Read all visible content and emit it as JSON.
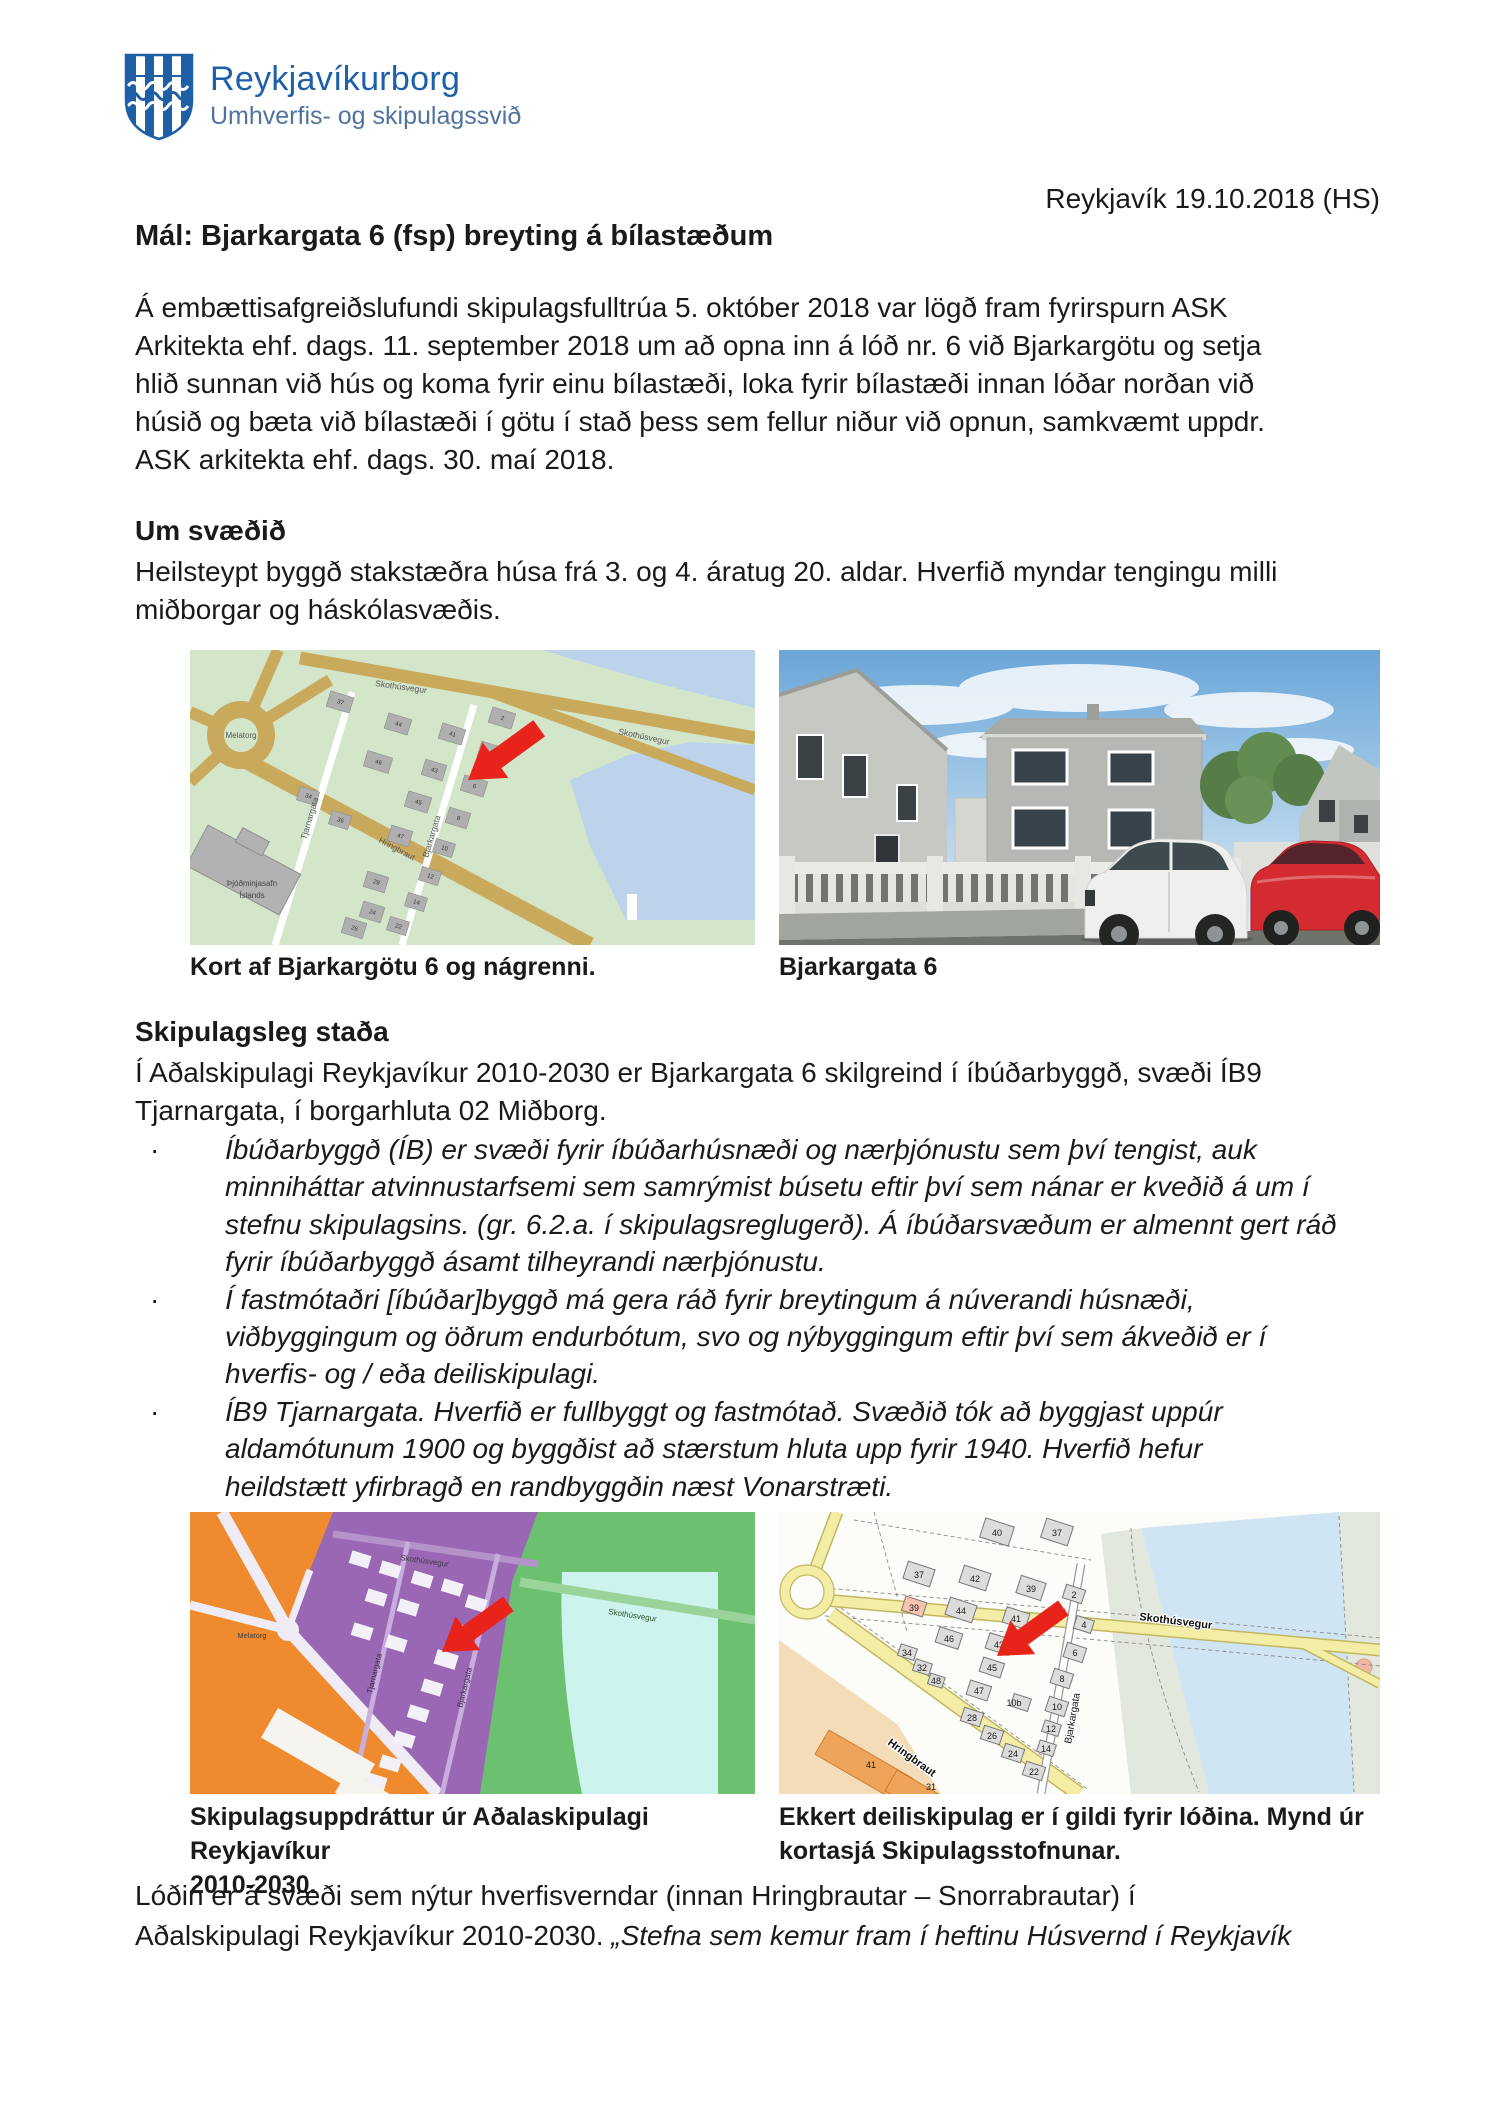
{
  "header": {
    "org_name": "Reykjavíkurborg",
    "org_dept": "Umhverfis- og skipulagssvið",
    "date_line": "Reykjavík 19.10.2018 (HS)",
    "title": "Mál: Bjarkargata 6 (fsp) breyting á bílastæðum"
  },
  "intro": {
    "lines": [
      "Á embættisafgreiðslufundi skipulagsfulltrúa 5. október 2018 var lögð fram fyrirspurn ASK",
      "Arkitekta ehf. dags. 11. september 2018 um að opna inn á lóð nr. 6 við Bjarkargötu og setja",
      "hlið sunnan við hús og koma fyrir einu bílastæði, loka fyrir bílastæði innan lóðar norðan við",
      "húsið og bæta við bílastæði í götu í stað þess sem fellur niður við opnun, samkvæmt uppdr.",
      "ASK arkitekta ehf. dags. 30. maí 2018."
    ]
  },
  "um_svaedid": {
    "heading": "Um svæðið",
    "lines": [
      "Heilsteypt byggð stakstæðra húsa frá 3. og 4. áratug 20. aldar. Hverfið myndar tengingu milli",
      "miðborgar og háskólasvæðis."
    ]
  },
  "figures_row1": {
    "left_caption": "Kort af Bjarkargötu 6 og nágrenni.",
    "right_caption": "Bjarkargata 6"
  },
  "skipulagsleg": {
    "heading": "Skipulagsleg staða",
    "lines": [
      "Í Aðalskipulagi Reykjavíkur 2010-2030 er Bjarkargata 6 skilgreind í íbúðarbyggð, svæði ÍB9",
      "Tjarnargata, í borgarhluta 02 Miðborg."
    ],
    "bullet_marker": "·",
    "bullets": [
      [
        "Íbúðarbyggð (ÍB) er svæði fyrir íbúðarhúsnæði og nærþjónustu sem því tengist, auk",
        "minniháttar atvinnustarfsemi sem samrýmist búsetu eftir því sem nánar er kveðið á um í",
        "stefnu skipulagsins. (gr. 6.2.a. í skipulagsreglugerð). Á íbúðarsvæðum er almennt gert ráð",
        "fyrir íbúðarbyggð ásamt tilheyrandi nærþjónustu."
      ],
      [
        "Í fastmótaðri [íbúðar]byggð má gera ráð fyrir breytingum á núverandi húsnæði,",
        "viðbyggingum og öðrum endurbótum, svo og nýbyggingum eftir því sem ákveðið er í",
        "hverfis- og / eða deiliskipulagi."
      ],
      [
        "ÍB9 Tjarnargata. Hverfið er fullbyggt og fastmótað. Svæðið tók að byggjast uppúr",
        "aldamótunum 1900 og byggðist að stærstum hluta upp fyrir 1940. Hverfið hefur",
        "heildstætt yfirbragð en randbyggðin næst Vonarstræti."
      ]
    ]
  },
  "figures_row2": {
    "left_caption_lines": [
      "Skipulagsuppdráttur úr Aðalaskipulagi Reykjavíkur",
      "2010-2030."
    ],
    "right_caption_lines": [
      "Ekkert deiliskipulag er í gildi fyrir lóðina. Mynd úr",
      "kortasjá Skipulagsstofnunar."
    ]
  },
  "closing": {
    "line1": "Lóðin er á svæði sem nýtur hverfisverndar (innan Hringbrautar – Snorrabrautar) í",
    "line2_normal": "Aðalskipulagi Reykjavíkur 2010-2030. ",
    "line2_italic": "„Stefna sem kemur fram í heftinu Húsvernd í Reykjavík"
  },
  "maps": {
    "map1": {
      "labels": {
        "melatorg": "Melatorg",
        "skothusvegur": "Skothúsvegur",
        "tjarnargata": "Tjarnargata",
        "bjarkargata": "Bjarkargata",
        "hringbraut": "Hringbraut",
        "museum_line1": "Þjóðminjasafn",
        "museum_line2": "Íslands"
      },
      "lots": [
        "37",
        "44",
        "46",
        "34",
        "36",
        "41",
        "43",
        "45",
        "47",
        "2",
        "4",
        "6",
        "8",
        "10",
        "12",
        "14",
        "22",
        "24",
        "26",
        "28"
      ]
    },
    "map3": {
      "labels": {
        "melatorg": "Melatorg",
        "skothusvegur": "Skothúsvegur",
        "tjarnargata": "Tjarnargata",
        "bjarkargata": "Bjarkargata"
      }
    },
    "map4": {
      "labels": {
        "skothusvegur": "Skothúsvegur",
        "bjarkargata": "Bjarkargata",
        "hringbraut": "Hringbraut"
      },
      "lots": [
        "40",
        "37",
        "37",
        "42",
        "39",
        "2",
        "39",
        "44",
        "41",
        "4",
        "46",
        "43",
        "6",
        "34",
        "32",
        "48",
        "45",
        "8",
        "47",
        "10b",
        "10",
        "28",
        "26",
        "24",
        "22",
        "12",
        "14",
        "41",
        "31"
      ]
    }
  },
  "colors": {
    "logo_blue": "#1d5fa8",
    "dept_blue": "#50749e",
    "arrow_red": "#e8231a",
    "map_green": "#d4e6ca",
    "map_water": "#bdd3ec",
    "map_road_tan": "#c9a95c",
    "plan_orange": "#ef8a2e",
    "plan_purple": "#9a67b5",
    "plan_green": "#6cc171",
    "plan_cyan": "#cdf3ef",
    "cadastre_yellow": "#f4eda6",
    "cadastre_water": "#cfe5f4"
  }
}
